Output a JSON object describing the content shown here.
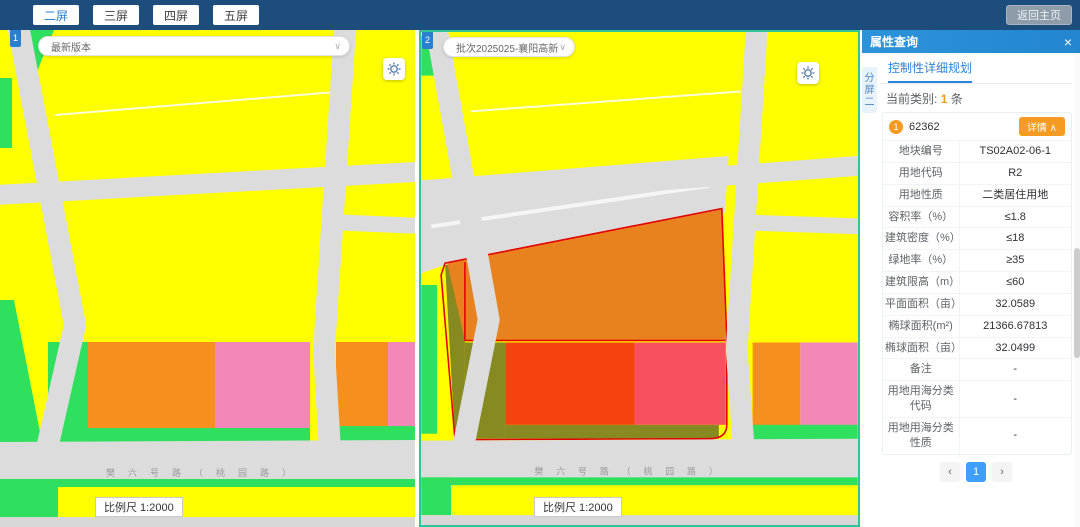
{
  "topbar": {
    "buttons": [
      {
        "label": "二屏",
        "active": true
      },
      {
        "label": "三屏",
        "active": false
      },
      {
        "label": "四屏",
        "active": false
      },
      {
        "label": "五屏",
        "active": false
      }
    ],
    "home_label": "返回主页"
  },
  "map1": {
    "badge": "1",
    "version_select": "最新版本",
    "select_caret": "∨",
    "road_label": "樊六号路（桃园路）",
    "scale_label": "比例尺 1:2000"
  },
  "map2": {
    "badge": "2",
    "version_select": "批次2025025-襄阳高新技",
    "select_caret": "∨",
    "road_label": "樊六号路（桃园路）",
    "scale_label": "比例尺 1:2000"
  },
  "panel": {
    "title": "属性查询",
    "close_icon": "×",
    "side_tab": "分屏二",
    "tab": "控制性详细规划",
    "category_prefix": "当前类别:",
    "category_count": "1",
    "category_suffix": "条",
    "record": {
      "marker": "1",
      "id": "62362",
      "detail_button": "详情 ∧",
      "fields": [
        {
          "label": "地块编号",
          "value": "TS02A02-06-1"
        },
        {
          "label": "用地代码",
          "value": "R2"
        },
        {
          "label": "用地性质",
          "value": "二类居住用地"
        },
        {
          "label": "容积率（%）",
          "value": "≤1.8"
        },
        {
          "label": "建筑密度（%）",
          "value": "≤18"
        },
        {
          "label": "绿地率（%）",
          "value": "≥35"
        },
        {
          "label": "建筑限高（m）",
          "value": "≤60"
        },
        {
          "label": "平面面积（亩）",
          "value": "32.0589"
        },
        {
          "label": "椭球面积(m²)",
          "value": "21366.67813"
        },
        {
          "label": "椭球面积（亩）",
          "value": "32.0499"
        },
        {
          "label": "备注",
          "value": "-"
        },
        {
          "label": "用地用海分类代码",
          "value": "-"
        },
        {
          "label": "用地用海分类性质",
          "value": "-"
        }
      ]
    },
    "pagination": {
      "prev": "‹",
      "page": "1",
      "next": "›"
    }
  },
  "palette": {
    "yellow": "#ffff00",
    "green": "#2ee05e",
    "road": "#dcdcdc",
    "orange": "#f78f1e",
    "pink": "#f287b8",
    "selected_orange": "#e8821e",
    "olive": "#878a21",
    "vermilion": "#f5430e",
    "rose": "#f8505f",
    "red_outline": "#e60000",
    "bottom_gray": "#d8d8d8"
  }
}
